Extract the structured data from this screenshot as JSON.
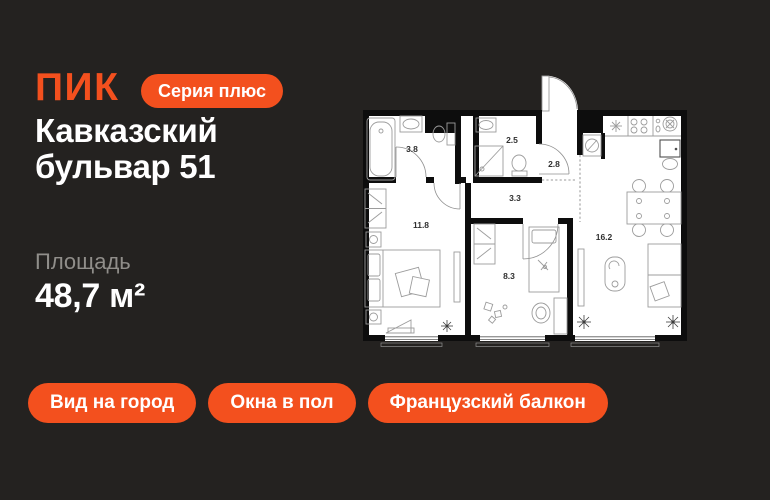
{
  "colors": {
    "background": "#242220",
    "accent": "#F3501E",
    "text_primary": "#FFFFFF",
    "text_secondary": "#908E8A",
    "plan_bg": "#FFFFFF",
    "plan_walls": "#0D0D0D"
  },
  "header": {
    "logo": "ПИК",
    "series_badge": "Серия плюс"
  },
  "project": {
    "title": "Кавказский бульвар 51"
  },
  "area": {
    "label": "Площадь",
    "value": "48,7 м²"
  },
  "features": [
    "Вид на город",
    "Окна в пол",
    "Французский балкон"
  ],
  "floor_plan": {
    "rooms": [
      {
        "name": "bathroom",
        "area": "3.8"
      },
      {
        "name": "shower-room",
        "area": "2.5"
      },
      {
        "name": "hallway",
        "area": "2.8"
      },
      {
        "name": "corridor",
        "area": "3.3"
      },
      {
        "name": "bedroom",
        "area": "11.8"
      },
      {
        "name": "kids-room",
        "area": "8.3"
      },
      {
        "name": "kitchen-living-room",
        "area": "16.2"
      }
    ]
  }
}
